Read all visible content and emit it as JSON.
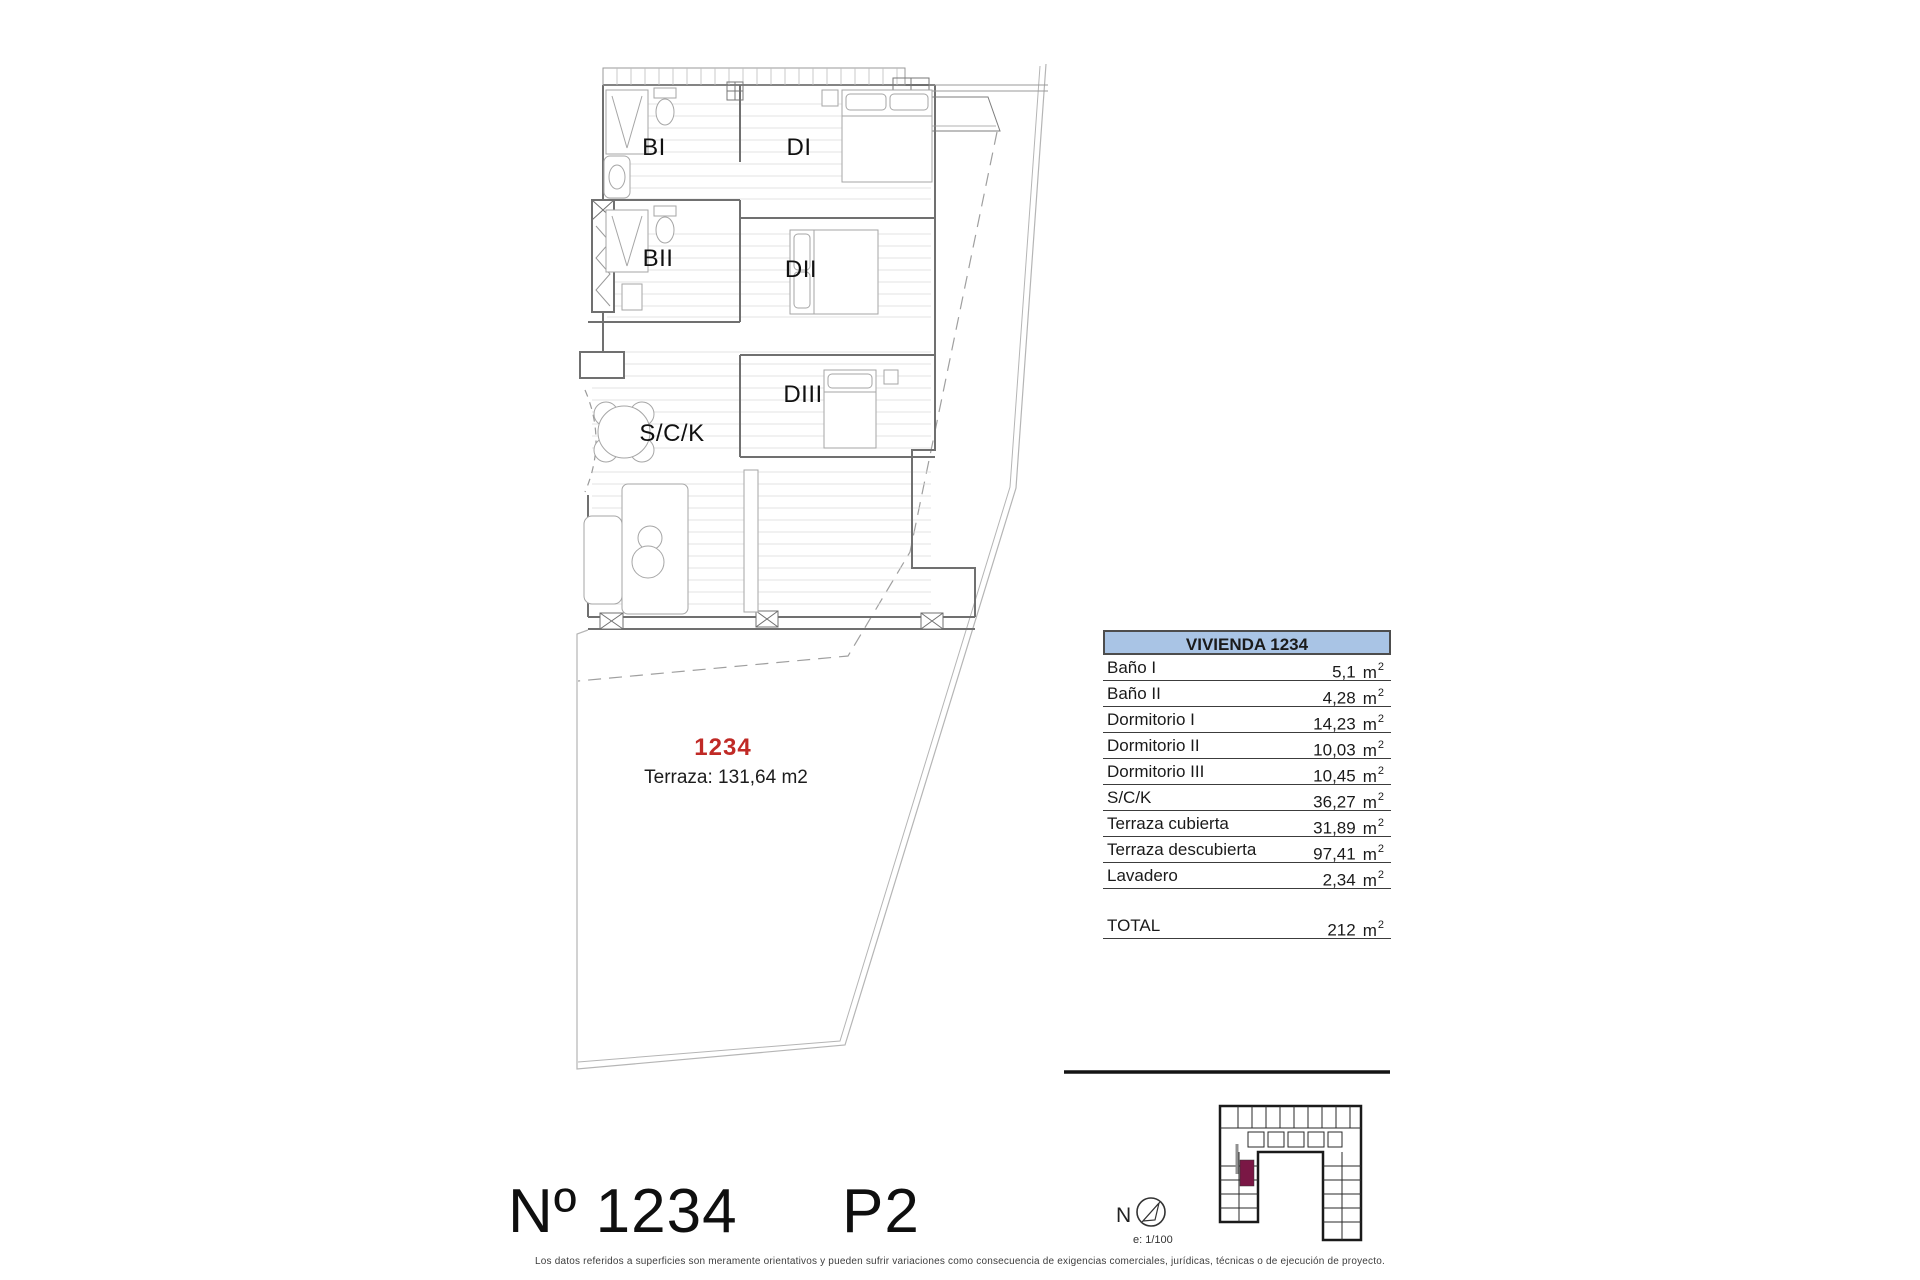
{
  "plan": {
    "unit_number_red": "1234",
    "terrace_note": "Terraza: 131,64 m2",
    "rooms": {
      "bi": "BI",
      "di": "DI",
      "bii": "BII",
      "dii": "DII",
      "diii": "DIII",
      "sck": "S/C/K"
    }
  },
  "table": {
    "header": "VIVIENDA 1234",
    "unit": "m",
    "unit_sup": "2",
    "rows": [
      {
        "label": "Baño I",
        "value": "5,1"
      },
      {
        "label": "Baño II",
        "value": "4,28"
      },
      {
        "label": "Dormitorio I",
        "value": "14,23"
      },
      {
        "label": "Dormitorio II",
        "value": "10,03"
      },
      {
        "label": "Dormitorio III",
        "value": "10,45"
      },
      {
        "label": "S/C/K",
        "value": "36,27"
      },
      {
        "label": "Terraza cubierta",
        "value": "31,89"
      },
      {
        "label": "Terraza descubierta",
        "value": "97,41"
      },
      {
        "label": "Lavadero",
        "value": "2,34"
      }
    ],
    "total": {
      "label": "TOTAL",
      "value": "212"
    }
  },
  "footer": {
    "unit_number": "Nº 1234",
    "floor": "P2",
    "compass_letter": "N",
    "scale": "e: 1/100",
    "disclaimer": "Los datos referidos a superficies son meramente orientativos y pueden sufrir variaciones como consecuencia de exigencias comerciales, jurídicas, técnicas o de ejecución de proyecto."
  },
  "colors": {
    "table_header_blue": "#a9c4e5",
    "unit_number_red": "#c02a26",
    "minimap_highlight": "#7a1745",
    "plan_line_gray": "#8c8c8c"
  }
}
